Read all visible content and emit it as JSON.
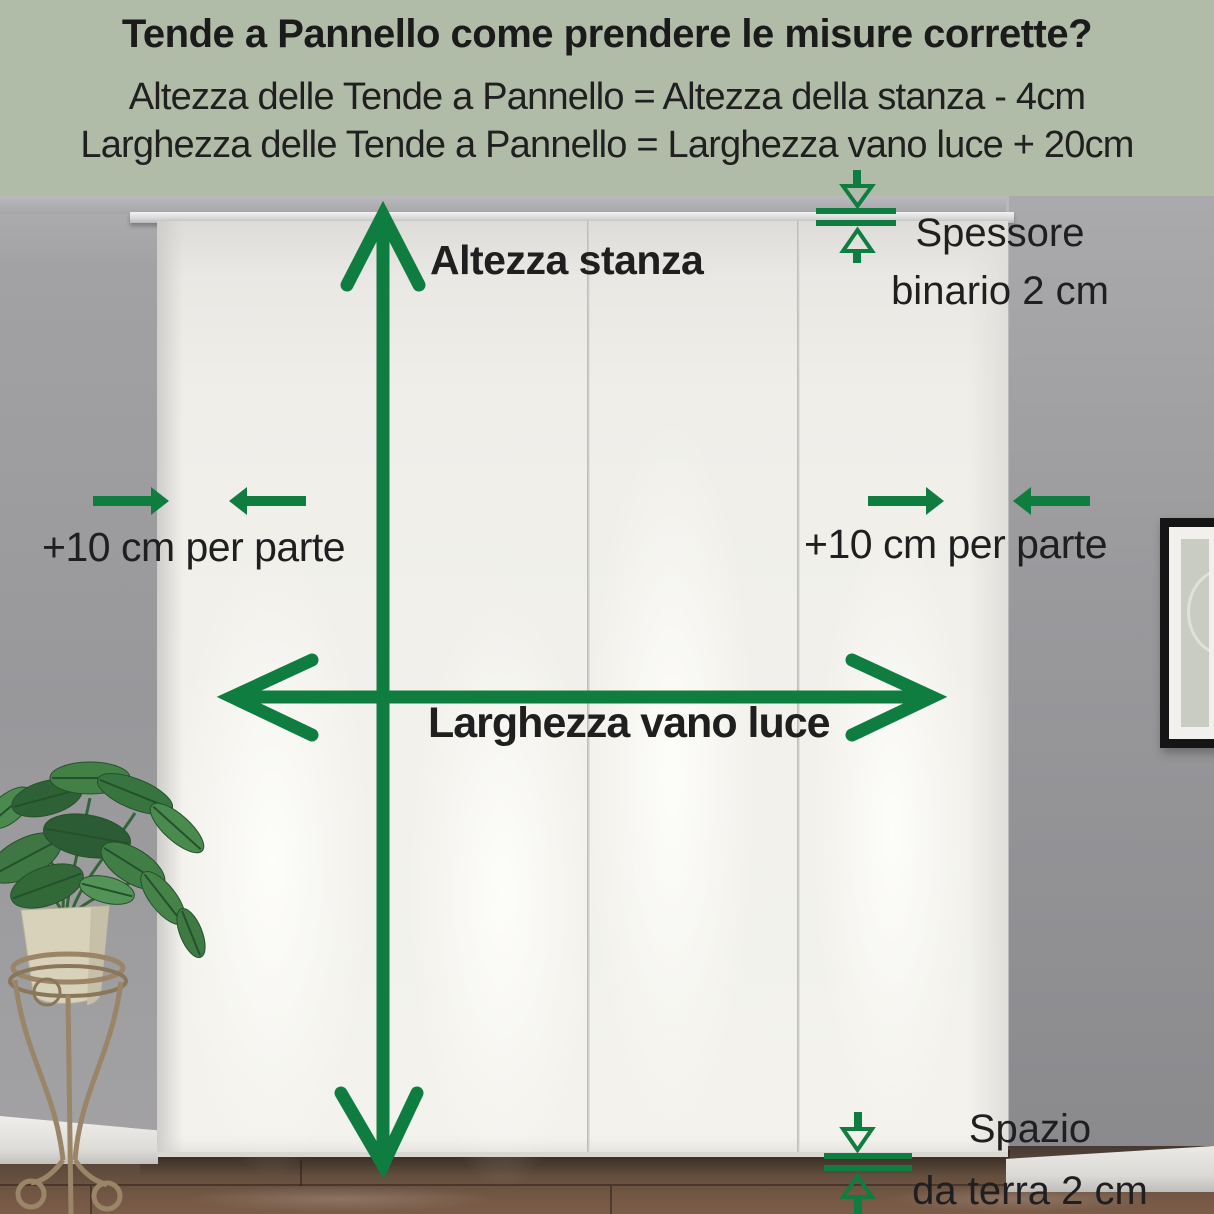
{
  "header": {
    "title": "Tende a Pannello come prendere le misure corrette?",
    "formula_height": "Altezza delle Tende a Pannello = Altezza della stanza - 4cm",
    "formula_width": "Larghezza delle Tende a Pannello = Larghezza vano luce + 20cm"
  },
  "diagram": {
    "room_height_label": "Altezza stanza",
    "opening_width_label": "Larghezza vano luce",
    "side_margin_left_label": "+10 cm per parte",
    "side_margin_right_label": "+10 cm per parte",
    "rail_thickness_line1": "Spessore",
    "rail_thickness_line2": "binario 2 cm",
    "floor_gap_line1": "Spazio",
    "floor_gap_line2": "da terra 2 cm"
  },
  "icons": {
    "room_height_arrow": "double-headed-vertical-arrow",
    "opening_width_arrow": "double-headed-horizontal-arrow",
    "side_margin_arrows": "opposing-horizontal-arrows",
    "rail_thickness_icon": "gap-between-lines-arrows",
    "floor_gap_icon": "gap-between-lines-arrows"
  },
  "colors": {
    "accent_green": "#107d40",
    "header_background": "#b1bca8",
    "text": "#1d1d1d",
    "wall_gray": "#98989b",
    "curtain_white": "#f2f1ec",
    "floor_brown": "#6e5344"
  }
}
